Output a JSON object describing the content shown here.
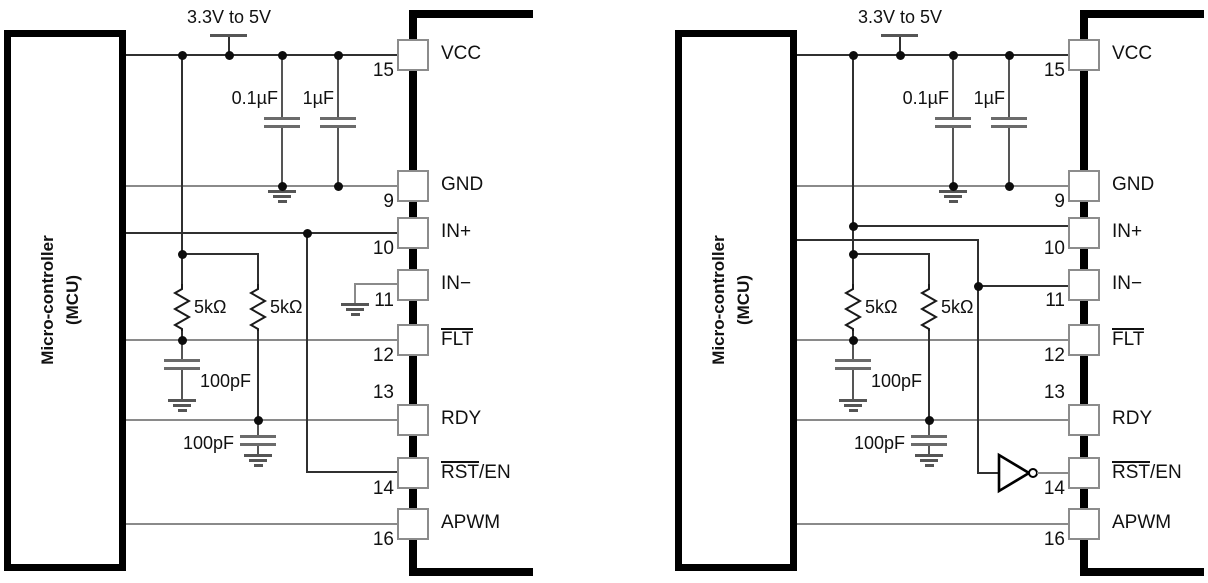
{
  "diagrams": [
    {
      "id": "left-circuit",
      "mcu": {
        "line1": "Micro-controller",
        "line2": "(MCU)"
      },
      "supply": {
        "label": "3.3V to 5V"
      },
      "components": {
        "decoupling_cap_1": "0.1µF",
        "decoupling_cap_2": "1µF",
        "pullup_resistor_1": "5kΩ",
        "pullup_resistor_2": "5kΩ",
        "flt_filter_cap": "100pF",
        "rdy_filter_cap": "100pF"
      },
      "pins": [
        {
          "label": "VCC",
          "overline": "",
          "rest": "VCC",
          "number": "15"
        },
        {
          "label": "GND",
          "overline": "",
          "rest": "GND",
          "number": "9"
        },
        {
          "label": "IN+",
          "overline": "",
          "rest": "IN+",
          "number": "10"
        },
        {
          "label": "IN−",
          "overline": "",
          "rest": "IN−",
          "number": "11"
        },
        {
          "label": "FLT",
          "overline": "FLT",
          "rest": "",
          "number": "12"
        },
        {
          "label": "RDY",
          "overline": "",
          "rest": "RDY",
          "number": "13"
        },
        {
          "label": "RST/EN",
          "overline": "RST",
          "rest": "/EN",
          "number": "14"
        },
        {
          "label": "APWM",
          "overline": "",
          "rest": "APWM",
          "number": "16"
        }
      ]
    },
    {
      "id": "right-circuit",
      "mcu": {
        "line1": "Micro-controller",
        "line2": "(MCU)"
      },
      "supply": {
        "label": "3.3V to 5V"
      },
      "components": {
        "decoupling_cap_1": "0.1µF",
        "decoupling_cap_2": "1µF",
        "pullup_resistor_1": "5kΩ",
        "pullup_resistor_2": "5kΩ",
        "flt_filter_cap": "100pF",
        "rdy_filter_cap": "100pF"
      },
      "pins": [
        {
          "label": "VCC",
          "overline": "",
          "rest": "VCC",
          "number": "15"
        },
        {
          "label": "GND",
          "overline": "",
          "rest": "GND",
          "number": "9"
        },
        {
          "label": "IN+",
          "overline": "",
          "rest": "IN+",
          "number": "10"
        },
        {
          "label": "IN−",
          "overline": "",
          "rest": "IN−",
          "number": "11"
        },
        {
          "label": "FLT",
          "overline": "FLT",
          "rest": "",
          "number": "12"
        },
        {
          "label": "RDY",
          "overline": "",
          "rest": "RDY",
          "number": "13"
        },
        {
          "label": "RST/EN",
          "overline": "RST",
          "rest": "/EN",
          "number": "14"
        },
        {
          "label": "APWM",
          "overline": "",
          "rest": "APWM",
          "number": "16"
        }
      ]
    }
  ]
}
